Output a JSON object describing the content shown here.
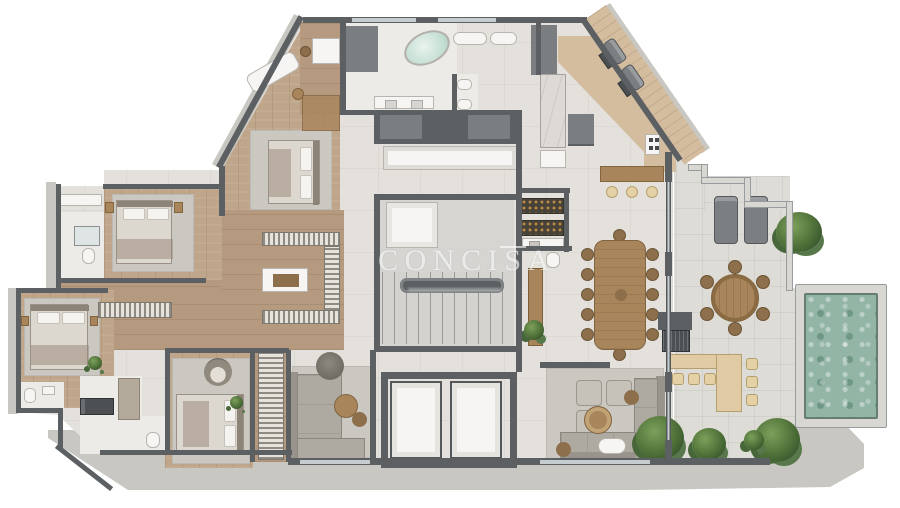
{
  "watermark": {
    "text": "CONCISA"
  },
  "palette": {
    "outer": "#c9c7c2",
    "outer2": "#d9d7d2",
    "wall": "#5c6063",
    "wall2": "#7a7e81",
    "tile": "#e4e1dc",
    "bath": "#edebe7",
    "wood": "#bfa68b",
    "wood2": "#b59a7f",
    "deck": "#d4bd9f",
    "terrace": "#dedcd6",
    "pool": "#93b5a6",
    "plant": "#4e7038",
    "rug": "#cbc8c2",
    "sofa": "#aeaaa1",
    "sofadark": "#98948b",
    "fwood": "#a9855c",
    "fwood2": "#8d6f4b",
    "whitefix": "#f6f5f3",
    "mint": "#c2ded2",
    "glass": "#c6cdd0"
  },
  "legend": {
    "zones": [
      "master-suite",
      "master-bathroom",
      "walk-in-closet",
      "suite-2",
      "suite-3",
      "suite-4",
      "tv-room",
      "living-room",
      "dining-room",
      "kitchen",
      "pantry-bar",
      "laundry",
      "powder-room",
      "stair-core",
      "elevator-hall",
      "gourmet-terrace",
      "pool-deck",
      "roof-deck"
    ],
    "objects": [
      "double-bed",
      "oval-bathtub",
      "chaise-longue",
      "dining-table",
      "modular-sofa",
      "round-table",
      "kitchen-island",
      "bar-counter",
      "grill",
      "wine-rack",
      "washer",
      "sun-lounger",
      "pool",
      "plants"
    ]
  },
  "counts": {
    "bedrooms": 4,
    "elevators": 2,
    "pools": 1,
    "dining_table_seats": 12,
    "terrace_round_table_seats": 6,
    "kitchen_island_stools": 3,
    "gourmet_bar_stools": 6,
    "sun_loungers": 4
  }
}
